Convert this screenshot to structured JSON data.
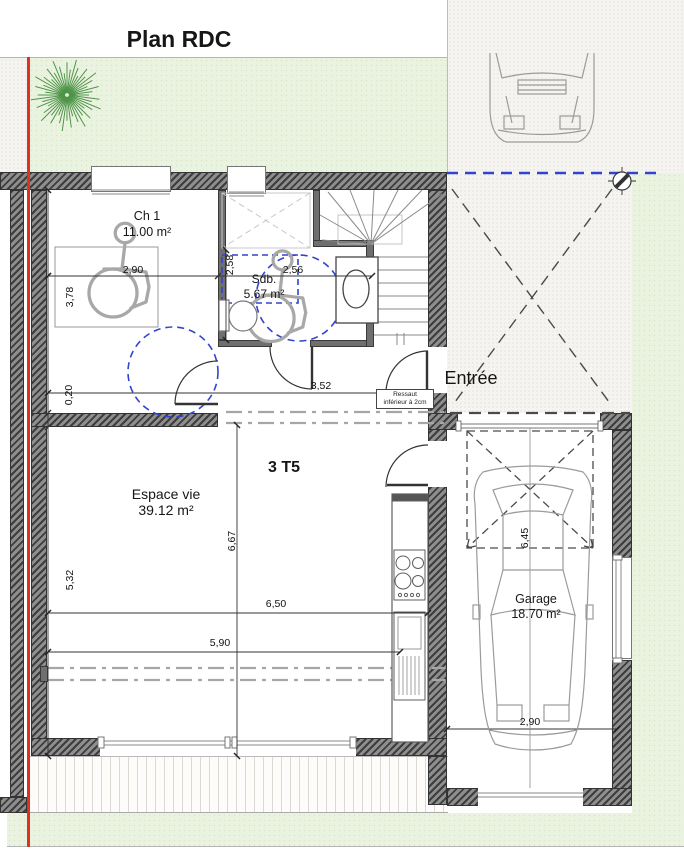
{
  "title": "Plan RDC",
  "unit_label": "3 T5",
  "rooms": {
    "ch1": {
      "name": "Ch 1",
      "area": "11.00 m²"
    },
    "sdb": {
      "name": "Sdb.",
      "area": "5.67 m²"
    },
    "living": {
      "name": "Espace vie",
      "area": "39.12 m²"
    },
    "garage": {
      "name": "Garage",
      "area": "18.70 m²"
    }
  },
  "labels": {
    "entrance": "Entrée"
  },
  "note": {
    "line1": "Ressaut",
    "line2": "inférieur à 2cm"
  },
  "dimensions": {
    "ch1_width": "2,90",
    "ch1_depth": "3,78",
    "wall_thickness": "0,20",
    "sdb_depth": "2,58",
    "sdb_width": "2,56",
    "hall_width": "3,52",
    "living_depth_left": "5,32",
    "living_depth_mid": "6,67",
    "living_width_upper": "6,50",
    "living_width_lower": "5,90",
    "garage_depth": "6,45",
    "garage_width": "2,90"
  },
  "colors": {
    "grass": "#eaf3e0",
    "paving": "#f5f4f1",
    "wall_dark": "#3d3d3d",
    "boundary_red": "#e0301e",
    "accessibility_blue": "#3344cc"
  }
}
